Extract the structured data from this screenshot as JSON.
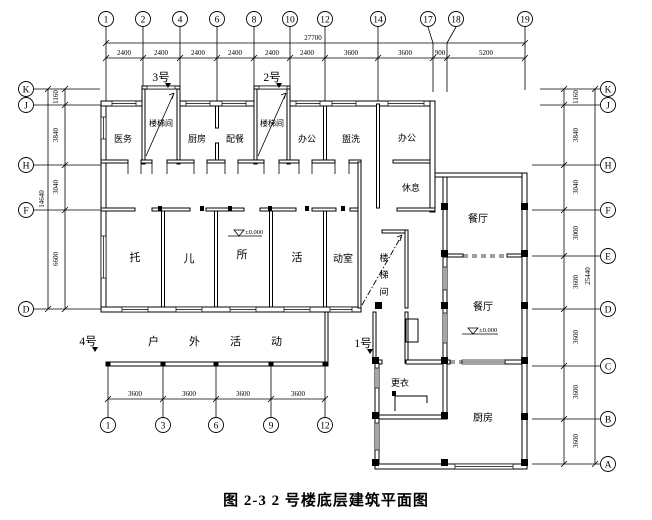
{
  "caption": "图 2-3 2 号楼底层建筑平面图",
  "axes": {
    "top": [
      "1",
      "2",
      "4",
      "6",
      "8",
      "10",
      "12",
      "14",
      "17",
      "18",
      "19"
    ],
    "left": [
      "K",
      "J",
      "H",
      "F",
      "D"
    ],
    "right": [
      "K",
      "J",
      "H",
      "F",
      "E",
      "D",
      "C",
      "B",
      "A"
    ],
    "bottom": [
      "1",
      "3",
      "6",
      "9",
      "12"
    ]
  },
  "dims": {
    "top_overall": "27700",
    "top": [
      "2400",
      "2400",
      "2400",
      "2400",
      "2400",
      "2400",
      "3600",
      "3600",
      "900",
      "5200"
    ],
    "left_overall": "14640",
    "left": [
      "1160",
      "3840",
      "3040",
      "6600"
    ],
    "right_overall": "25440",
    "right": [
      "1160",
      "3840",
      "3040",
      "3000",
      "3600",
      "3600",
      "3600",
      "3600"
    ],
    "bottom": [
      "3600",
      "3600",
      "3600",
      "3600"
    ]
  },
  "entrances": {
    "e3": "3号",
    "e2": "2号",
    "e4": "4号",
    "e1": "1号"
  },
  "rooms": {
    "yiwu": "医务",
    "louti_a": "楼梯间",
    "chufang": "厨房",
    "peican": "配餐",
    "louti_b": "楼梯间",
    "bangong1": "办公",
    "guanxi": "盥洗",
    "bangong2": "办公",
    "xiuxi": "休息",
    "tuo": "托",
    "er": "儿",
    "suo": "所",
    "huo": "活",
    "dongshi": "动室",
    "stair3_chars": [
      "楼",
      "梯",
      "间"
    ],
    "canting1": "餐厅",
    "canting2": "餐厅",
    "gengyi": "更衣",
    "chufang2": "厨房",
    "huwai": "户外活动"
  },
  "levels": {
    "upper": "±0.000",
    "lower": "±0.000"
  }
}
